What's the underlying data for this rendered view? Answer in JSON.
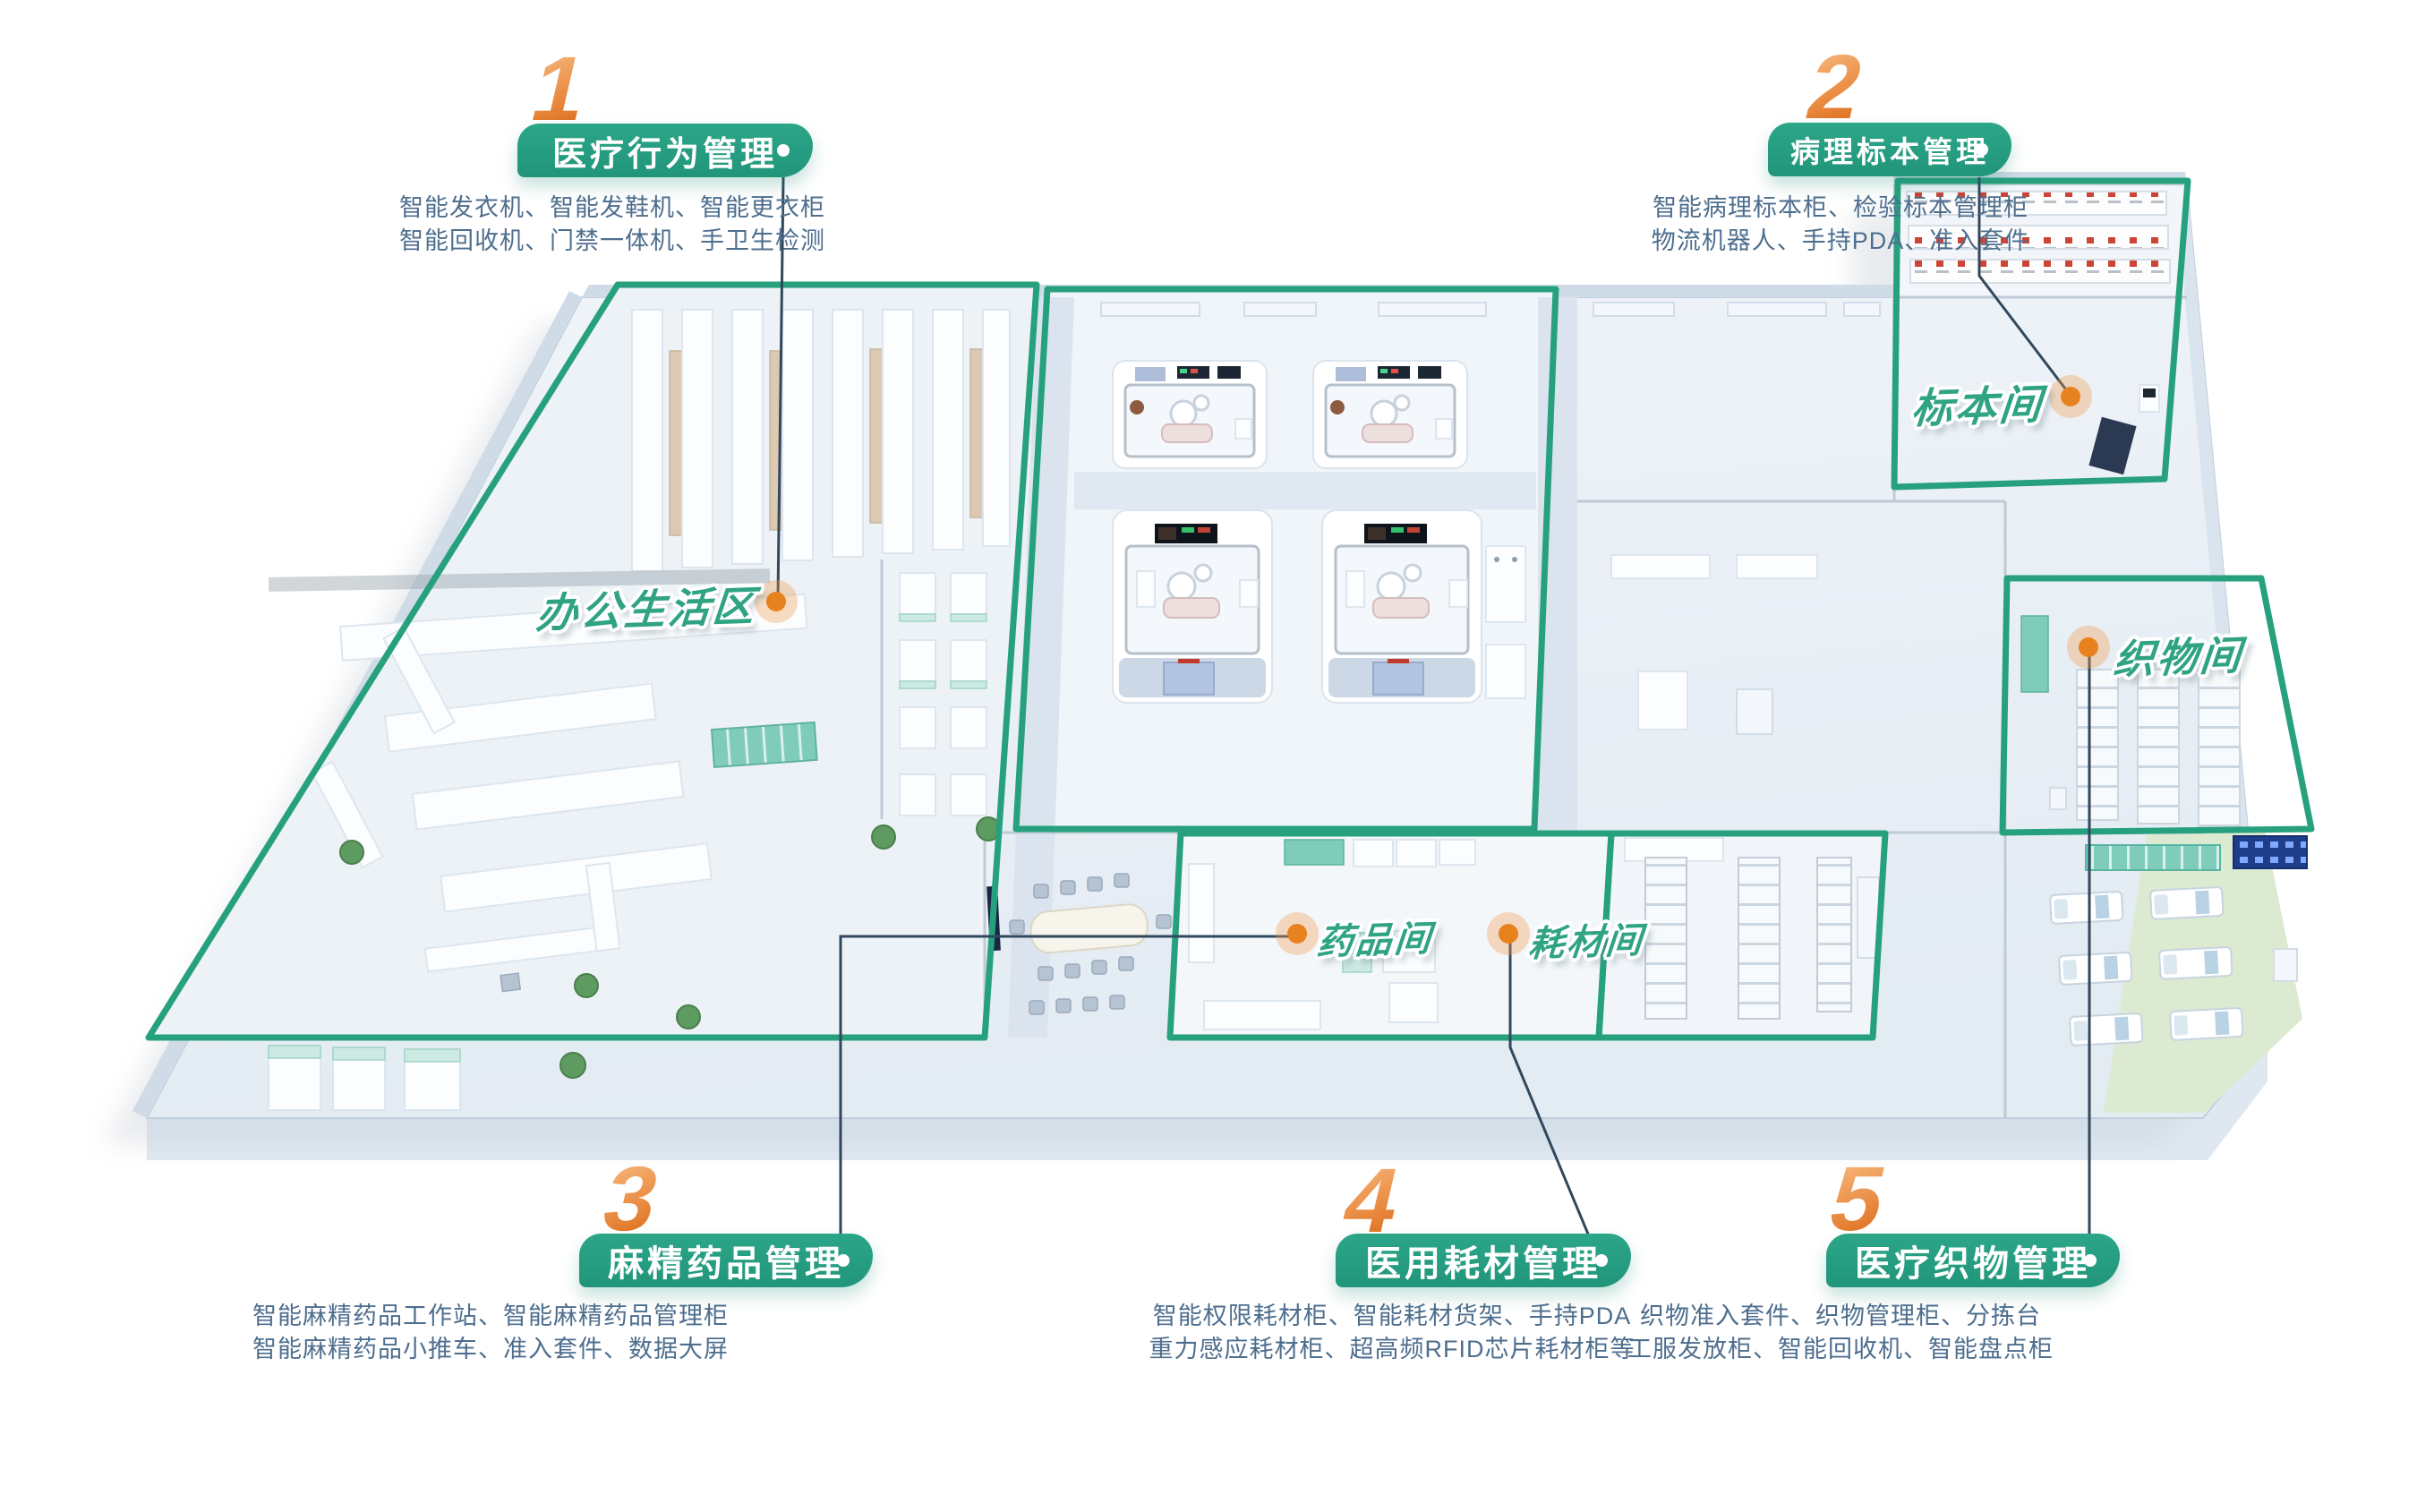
{
  "sections": [
    {
      "number": "1",
      "title": "医疗行为管理",
      "line1": "智能发衣机、智能发鞋机、智能更衣柜",
      "line2": "智能回收机、门禁一体机、手卫生检测"
    },
    {
      "number": "2",
      "title": "病理标本管理",
      "line1": "智能病理标本柜、检验标本管理柜",
      "line2": "物流机器人、手持PDA、准入套件"
    },
    {
      "number": "3",
      "title": "麻精药品管理",
      "line1": "智能麻精药品工作站、智能麻精药品管理柜",
      "line2": "智能麻精药品小推车、准入套件、数据大屏"
    },
    {
      "number": "4",
      "title": "医用耗材管理",
      "line1": "智能权限耗材柜、智能耗材货架、手持PDA",
      "line2": "重力感应耗材柜、超高频RFID芯片耗材柜等"
    },
    {
      "number": "5",
      "title": "医疗织物管理",
      "line1": "织物准入套件、织物管理柜、分拣台",
      "line2": "工服发放柜、智能回收机、智能盘点柜"
    }
  ],
  "rooms": {
    "office_area": {
      "name": "办公生活区"
    },
    "specimen_room": {
      "name": "标本间"
    },
    "textile_room": {
      "name": "织物间"
    },
    "medicine_room": {
      "name": "药品间"
    },
    "consumable_room": {
      "name": "耗材间"
    }
  },
  "colors": {
    "zone_outline_green": "#27a17d",
    "marker_orange": "#e8821e",
    "number_gradient_start": "#f5b173",
    "number_gradient_end": "#e0701f",
    "description_text": "#4e6e8e",
    "pill_green": "#2ca688"
  }
}
